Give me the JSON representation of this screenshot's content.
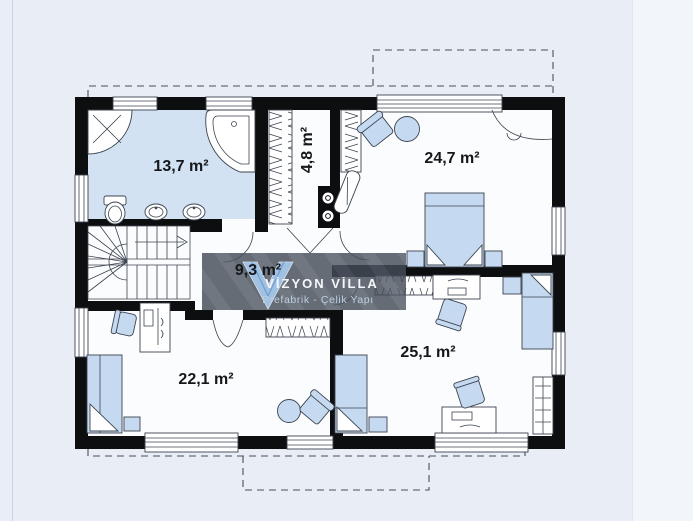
{
  "page": {
    "background": "#e9eef6",
    "right_panel_background": "#f2f5f9"
  },
  "plan": {
    "type": "floor-plan",
    "rooms": [
      {
        "id": "bathroom",
        "label": "13,7 m²"
      },
      {
        "id": "wardrobe-closet",
        "label": "4,8 m²"
      },
      {
        "id": "bedroom-top-right",
        "label": "24,7 m²"
      },
      {
        "id": "hallway-stairs",
        "label": "9,3 m²"
      },
      {
        "id": "bedroom-bottom-left",
        "label": "22,1 m²"
      },
      {
        "id": "bedroom-bottom-right",
        "label": "25,1 m²"
      }
    ],
    "colors": {
      "wall": "#0d0e10",
      "floor": "#fbfcfd",
      "bathroom_floor": "#d3e2f2",
      "furniture_fill": "#c5daf0",
      "dashed_outline": "#4a4f57",
      "watermark_band": "#454c57",
      "logo_blue": "#a8cdf2"
    }
  },
  "watermark": {
    "title": "VİZYON VİLLA",
    "subtitle": "Prefabrik - Çelik Yapı"
  }
}
